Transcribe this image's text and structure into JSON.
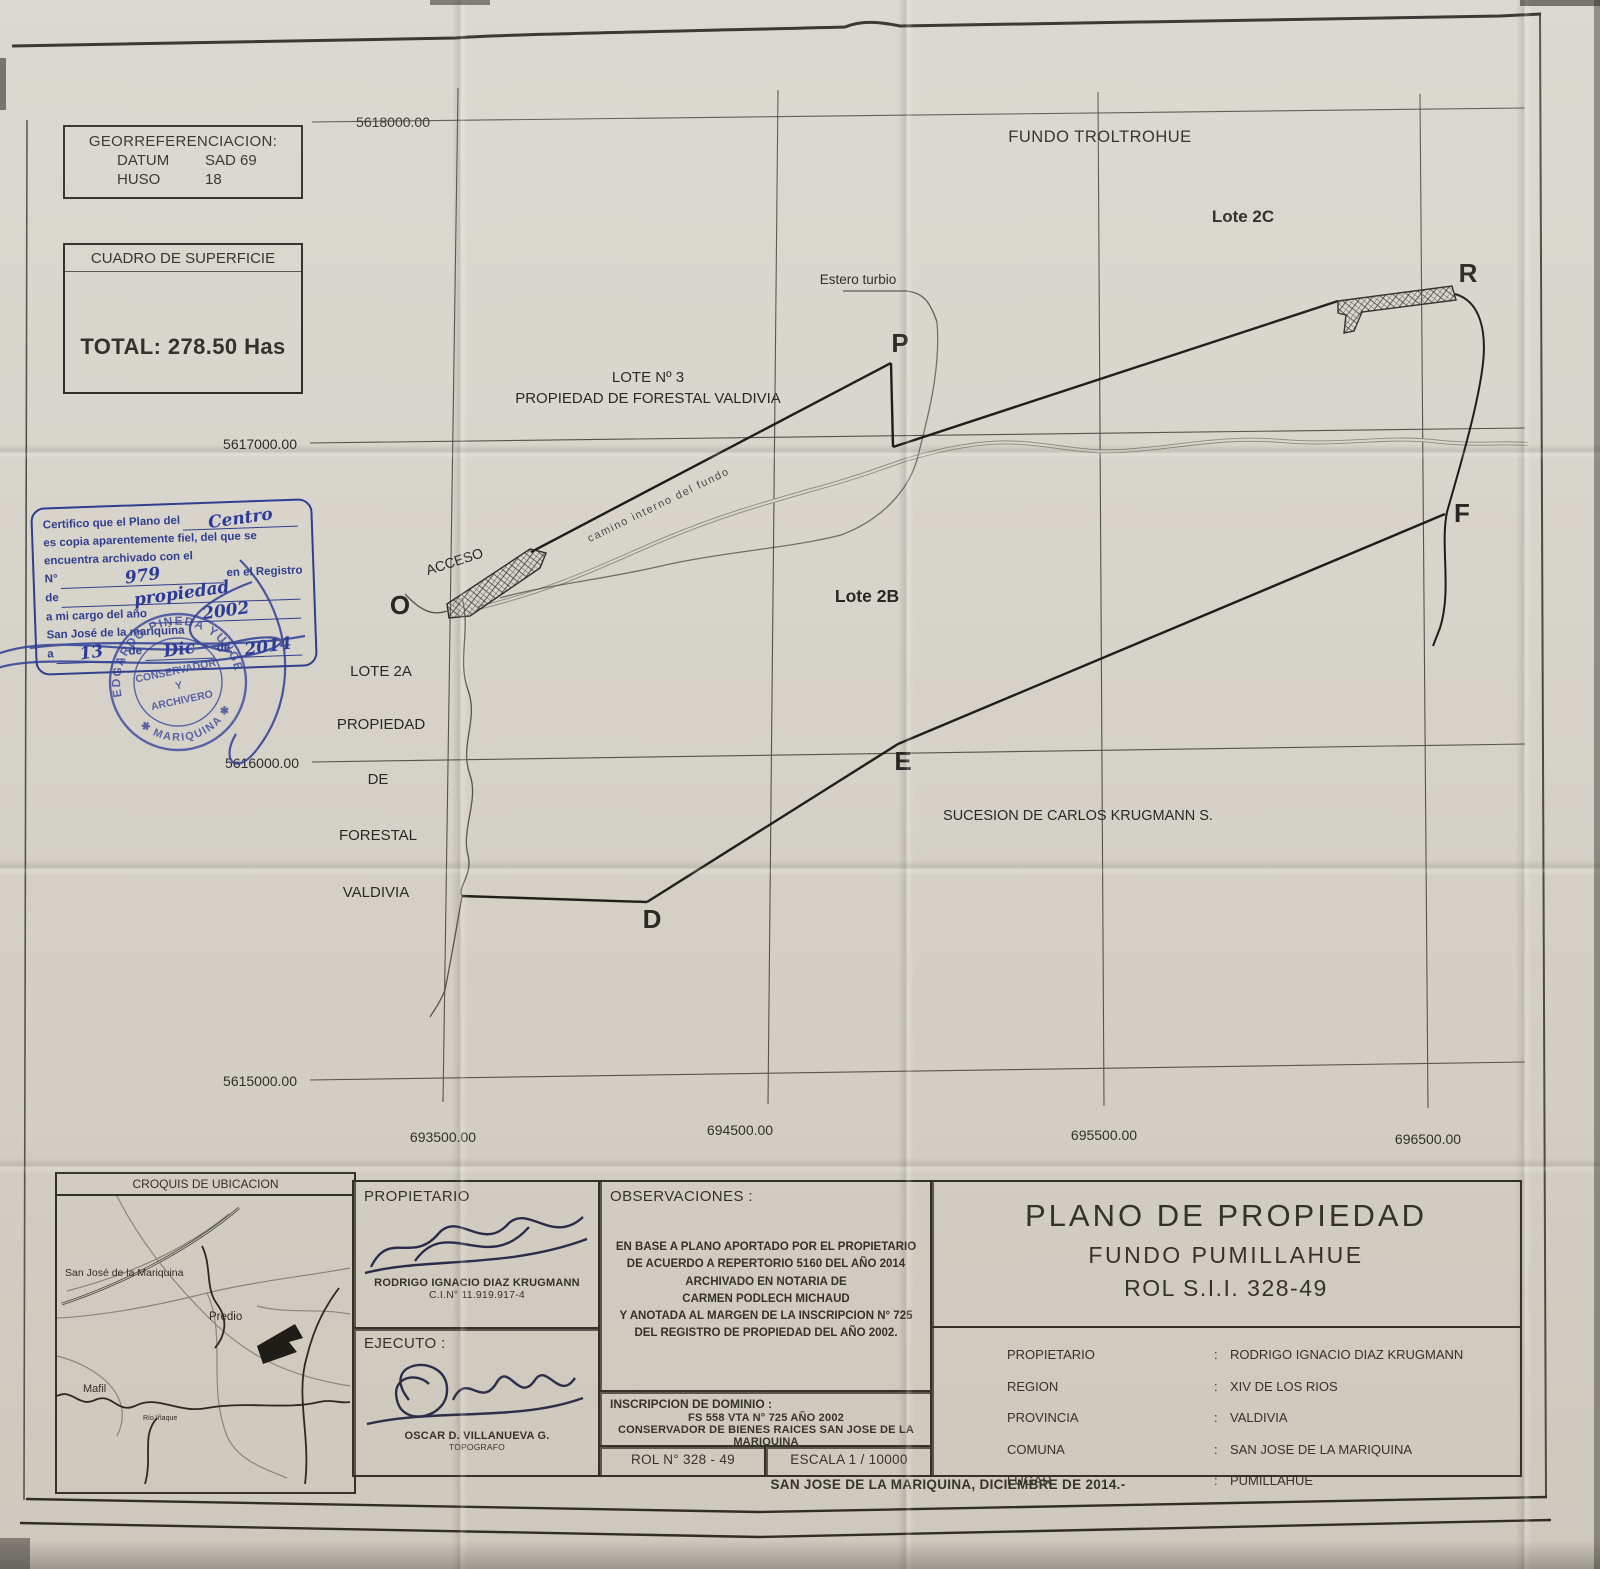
{
  "georef": {
    "title": "GEORREFERENCIACION:",
    "rows": [
      {
        "label": "DATUM",
        "value": "SAD 69"
      },
      {
        "label": "HUSO",
        "value": "18"
      }
    ]
  },
  "superficie": {
    "title": "CUADRO DE SUPERFICIE",
    "total": "TOTAL: 278.50 Has"
  },
  "grid": {
    "y": [
      "5618000.00",
      "5617000.00",
      "5616000.00",
      "5615000.00"
    ],
    "x": [
      "693500.00",
      "694500.00",
      "695500.00",
      "696500.00"
    ]
  },
  "map": {
    "fundo_troltrohue": "FUNDO TROLTROHUE",
    "lote_2c": "Lote 2C",
    "estero_turbio": "Estero turbio",
    "lote3_l1": "LOTE Nº 3",
    "lote3_l2": "PROPIEDAD DE FORESTAL VALDIVIA",
    "acceso": "ACCESO",
    "lote_2b": "Lote 2B",
    "camino": "camino interno  del  fundo",
    "lote2a": [
      "LOTE 2A",
      "PROPIEDAD",
      "DE",
      "FORESTAL",
      "VALDIVIA"
    ],
    "sucesion": "SUCESION DE CARLOS KRUGMANN S.",
    "pt_p": "P",
    "pt_r": "R",
    "pt_o": "O",
    "pt_f": "F",
    "pt_e": "E",
    "pt_d": "D"
  },
  "stamp": {
    "l1": "Certifico  que el Plano del",
    "h1": "Centro",
    "l2": "es copia aparentemente fiel, del que se",
    "l3": "encuentra archivado con el",
    "l4a": "N°",
    "h2": "979",
    "l4b": "en el Registro",
    "l5": "de",
    "h3": "propiedad",
    "l6": "a mi cargo del año",
    "h4": "2002",
    "l7": "San José de la mariquina",
    "l8a": "a",
    "h5": "13",
    "l8b": "de",
    "h6": "Dic",
    "l8c": "de",
    "h7": "2014",
    "seal_top": "EDGARDO PINEDA YUNGE",
    "seal_bottom": "✱ MARIQUINA ✱",
    "seal_c1": "CONSERVADOR",
    "seal_c2": "Y",
    "seal_c3": "ARCHIVERO"
  },
  "croquis": {
    "title": "CROQUIS DE UBICACION",
    "town": "San José de la Mariquina",
    "predio": "Predio",
    "mafil": "Mafil",
    "rio": "Río Iñaque"
  },
  "tb": {
    "propietario_label": "PROPIETARIO",
    "owner_name": "RODRIGO IGNACIO DIAZ KRUGMANN",
    "owner_ci": "C.I.N° 11.919.917-4",
    "ejecuto_label": "EJECUTO  :",
    "surveyor": "OSCAR D. VILLANUEVA G.",
    "surveyor_role": "TOPOGRAFO",
    "obs_label": "OBSERVACIONES  :",
    "obs": [
      "EN BASE A PLANO APORTADO POR EL PROPIETARIO",
      "DE ACUERDO A REPERTORIO 5160 DEL AÑO 2014",
      "ARCHIVADO EN NOTARIA DE",
      "CARMEN PODLECH MICHAUD",
      "Y ANOTADA AL MARGEN DE LA INSCRIPCION N° 725",
      "DEL REGISTRO DE PROPIEDAD DEL AÑO 2002."
    ],
    "insc_label": "INSCRIPCION DE DOMINIO  :",
    "insc": [
      "FS 558 VTA  N° 725 AÑO 2002",
      "CONSERVADOR DE BIENES RAICES SAN JOSE DE LA MARIQUINA"
    ],
    "rol": "ROL N°   328 - 49",
    "escala": "ESCALA   1 / 10000",
    "title1": "PLANO DE PROPIEDAD",
    "title2": "FUNDO PUMILLAHUE",
    "title3": "ROL S.I.I. 328-49",
    "colon": ":",
    "info": [
      {
        "label": "PROPIETARIO",
        "value": "RODRIGO IGNACIO DIAZ KRUGMANN"
      },
      {
        "label": "REGION",
        "value": "XIV DE LOS RIOS"
      },
      {
        "label": "PROVINCIA",
        "value": "VALDIVIA"
      },
      {
        "label": "COMUNA",
        "value": "SAN JOSE DE LA MARIQUINA"
      },
      {
        "label": "LUGAR",
        "value": "PUMILLAHUE"
      }
    ],
    "date_line": "SAN JOSE DE LA MARIQUINA, DICIEMBRE DE 2014.-"
  }
}
